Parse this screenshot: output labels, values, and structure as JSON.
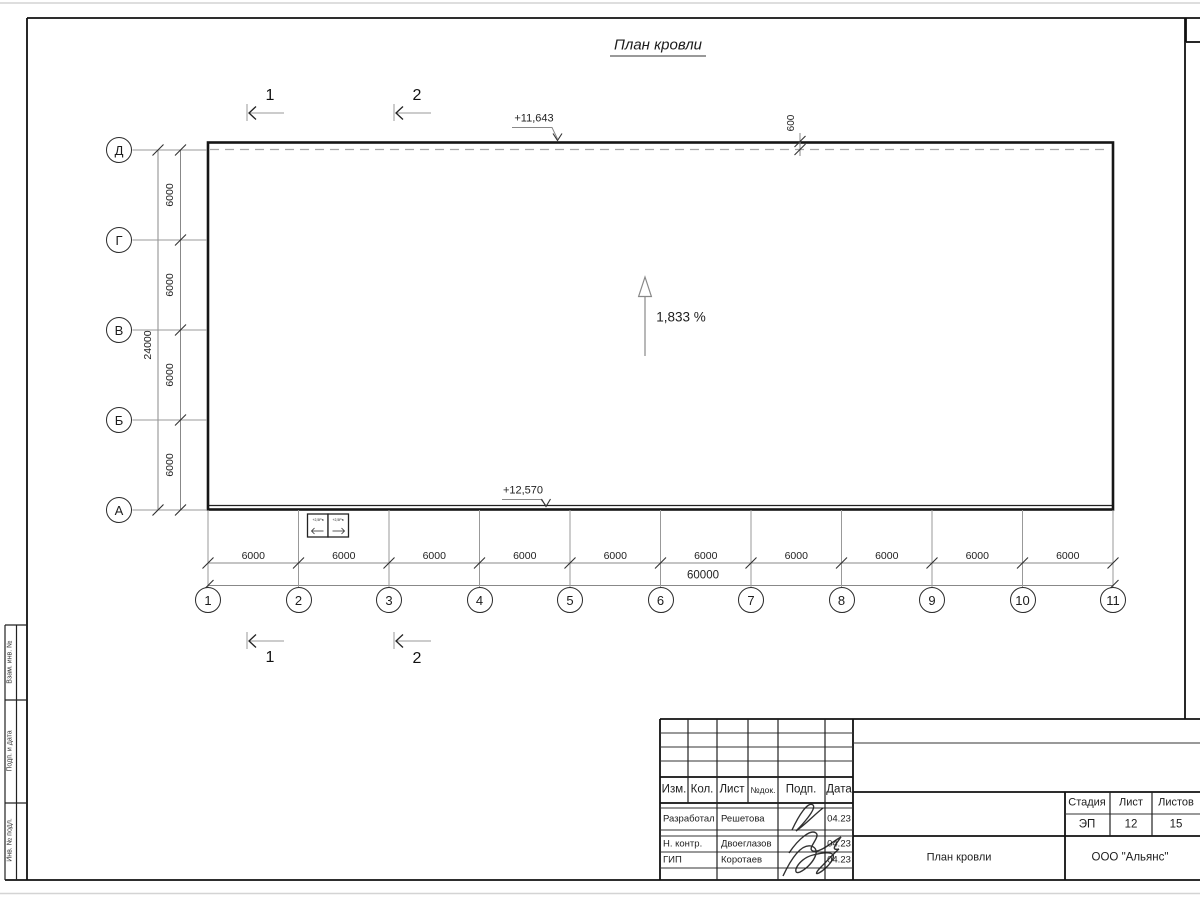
{
  "title": "План кровли",
  "ink_color": "#1c1c1c",
  "plan": {
    "row_axes": [
      "Д",
      "Г",
      "В",
      "Б",
      "А"
    ],
    "col_axes": [
      "1",
      "2",
      "3",
      "4",
      "5",
      "6",
      "7",
      "8",
      "9",
      "10",
      "11"
    ],
    "col_segment_dim": "6000",
    "col_total_dim": "60000",
    "row_segment_dim": "6000",
    "row_total_dim": "24000",
    "parapet_offset_dim": "600",
    "elevation_top": "+11,643",
    "elevation_bottom": "+12,570",
    "slope_label": "1,833 %",
    "section_marks": [
      "1",
      "2"
    ],
    "detail_boxes": [
      "+2,5Рв",
      "+2,5Рв"
    ]
  },
  "title_block": {
    "revision_header": [
      "Изм.",
      "Кол.",
      "Лист",
      "№док.",
      "Подп.",
      "Дата"
    ],
    "signature_rows": [
      {
        "role": "Разработал",
        "name": "Решетова",
        "date": "04.23"
      },
      {
        "role": "Н. контр.",
        "name": "Двоеглазов",
        "date": "04.23"
      },
      {
        "role": "ГИП",
        "name": "Коротаев",
        "date": "04.23"
      }
    ],
    "stage_cells": {
      "headers": [
        "Стадия",
        "Лист",
        "Листов"
      ],
      "values": [
        "ЭП",
        "12",
        "15"
      ]
    },
    "drawing_title": "План кровли",
    "company": "ООО \"Альянс\""
  },
  "frame_labels": {
    "side_column": [
      "Взам. инв. №",
      "Подп. и дата",
      "Инв. № подл."
    ]
  }
}
